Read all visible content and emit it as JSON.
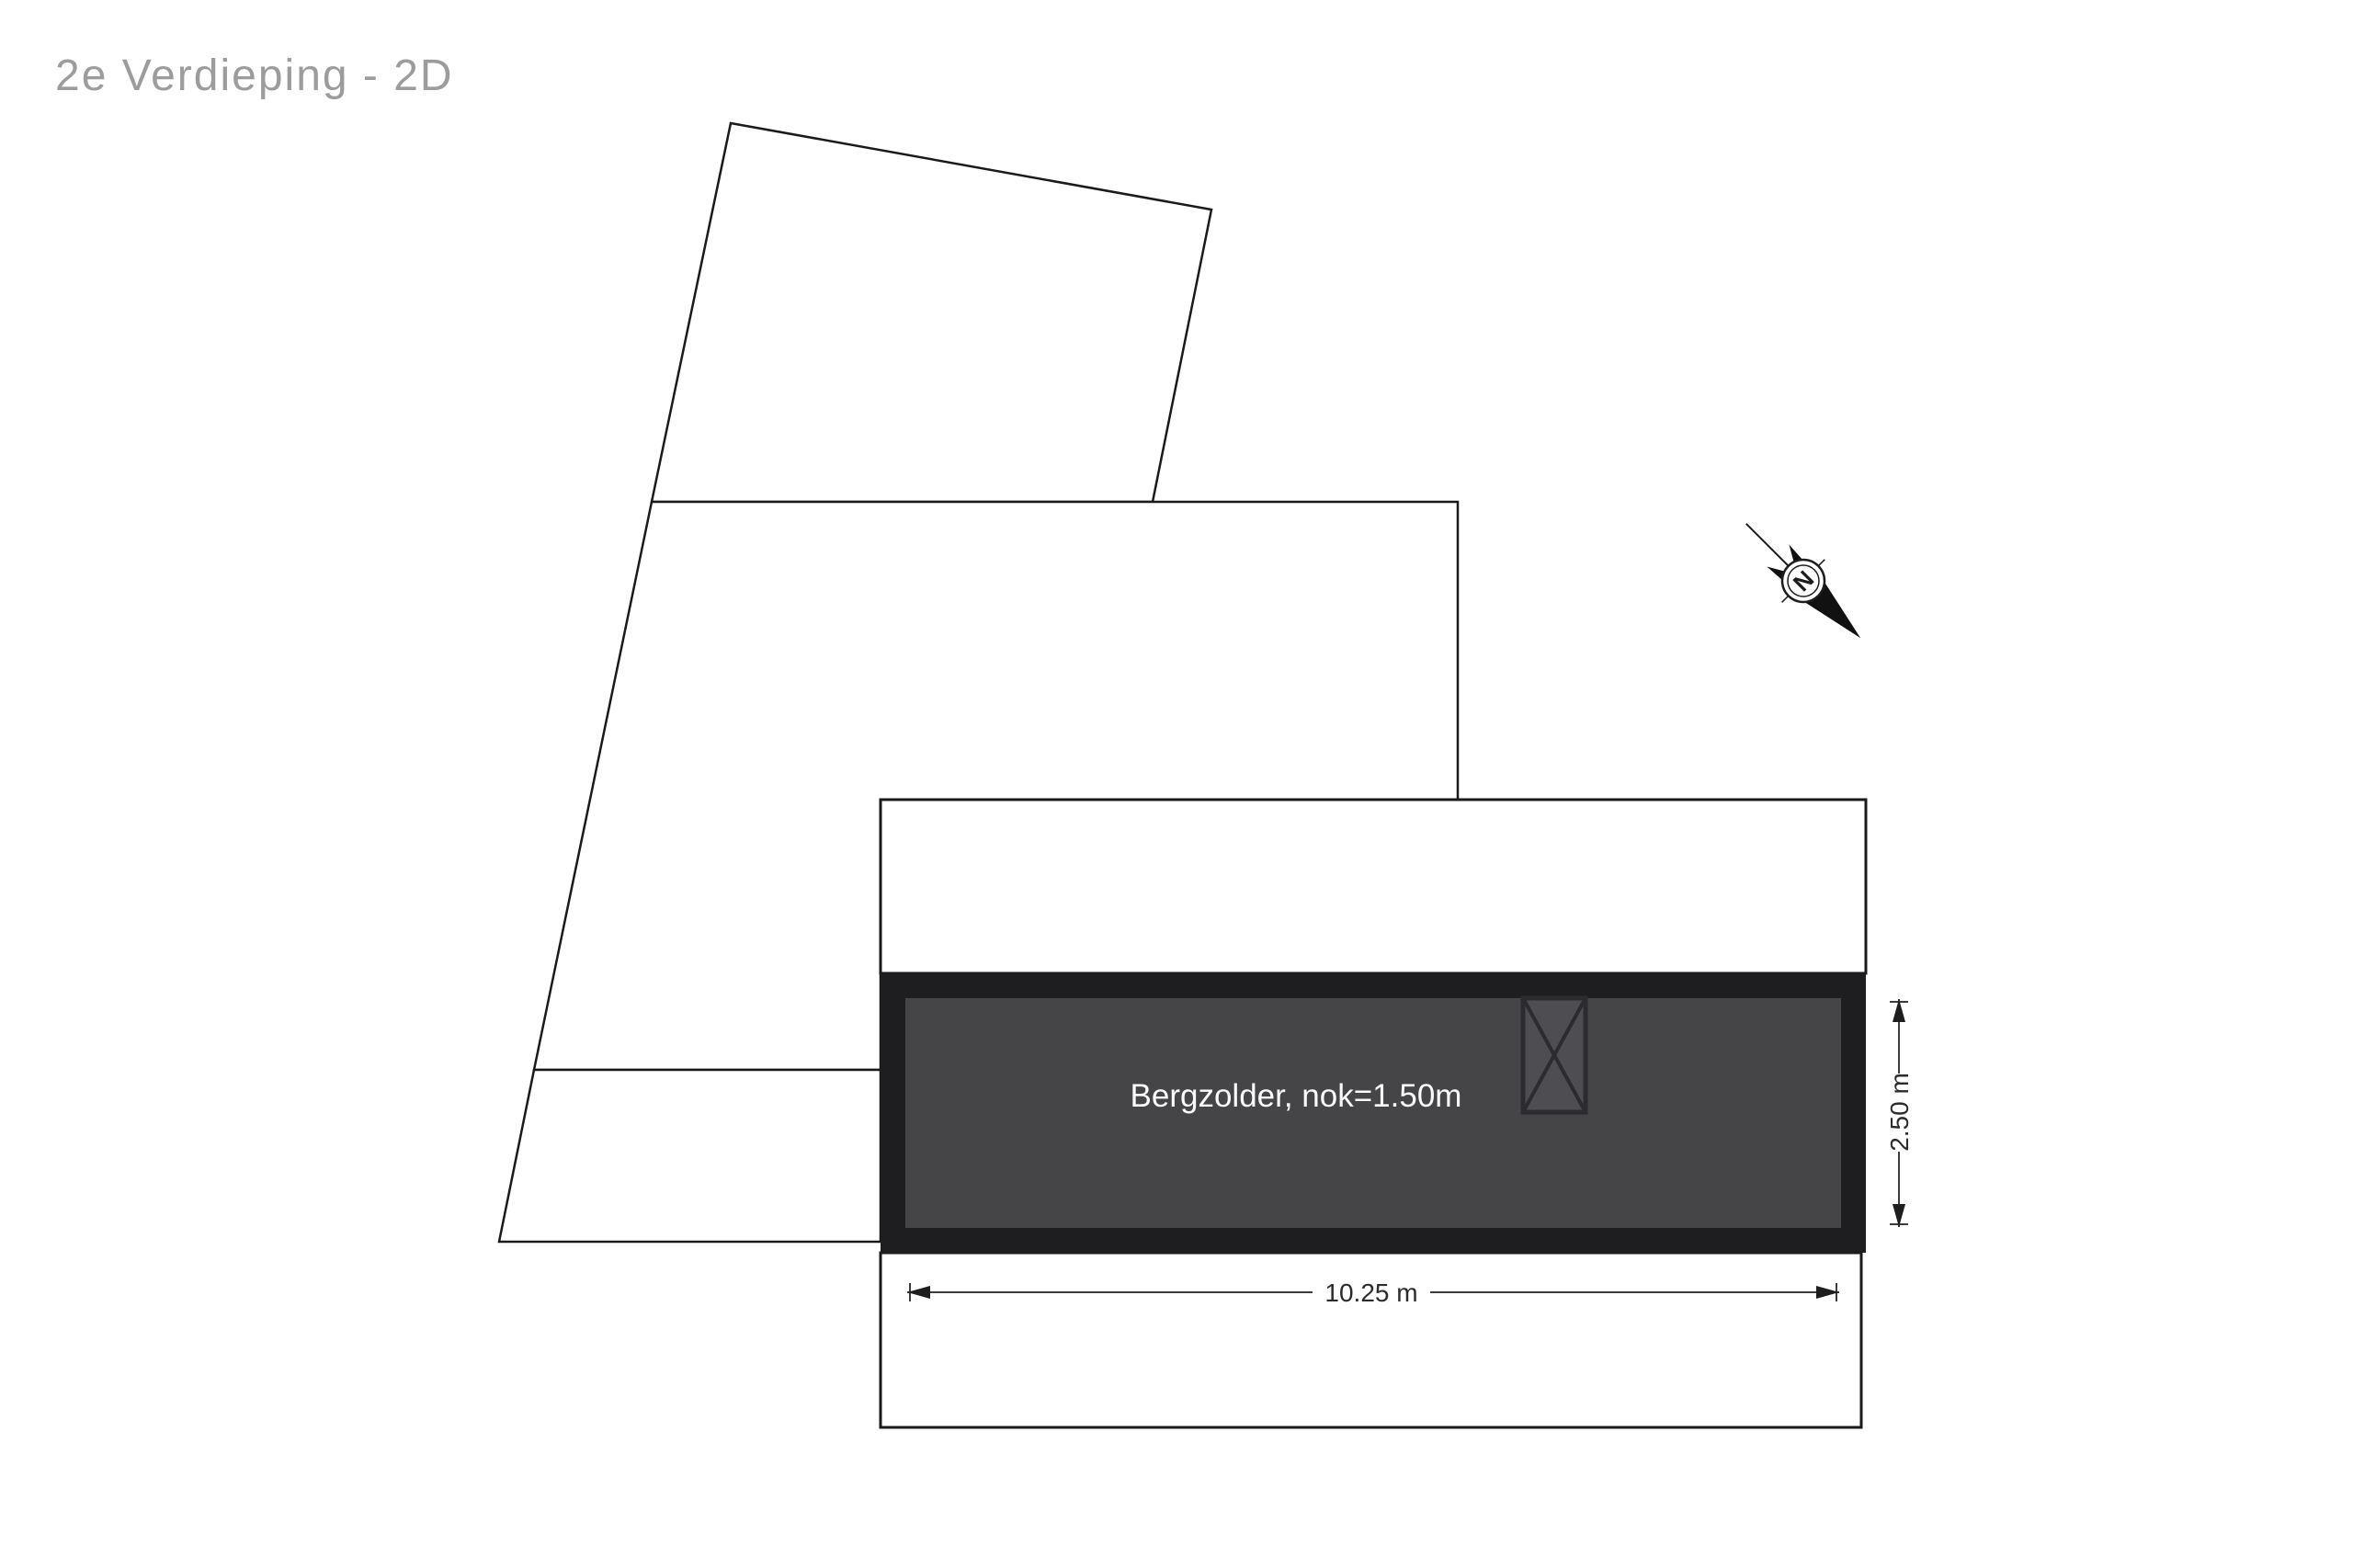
{
  "title": "2e Verdieping - 2D",
  "room": {
    "label": "Bergzolder, nok=1.50m"
  },
  "dimensions": {
    "width_label": "10.25 m",
    "height_label": "2.50 m"
  },
  "compass": {
    "letter": "N"
  },
  "colors": {
    "background": "#ffffff",
    "outline_stroke": "#1a1a1a",
    "title_text": "#9c9c9c",
    "room_wall": "#1e1e20",
    "room_floor": "#454548",
    "room_label_text": "#fafafa",
    "dimension_line": "#3c3c3c",
    "dimension_text": "#2b2b2b"
  }
}
